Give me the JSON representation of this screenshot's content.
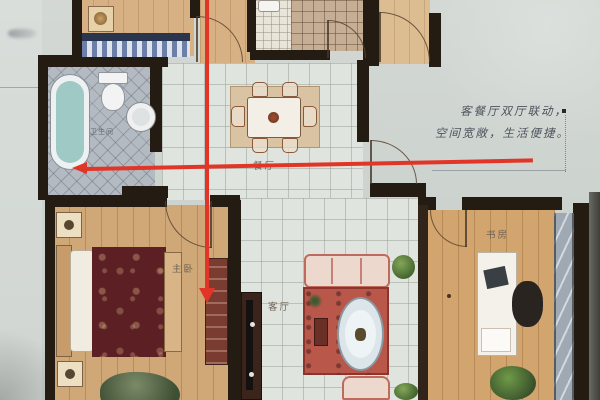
{
  "photo": {
    "kind": "apartment floor plan photograph",
    "page_bg": "#cdd3cf",
    "arrow_color": "#e13527"
  },
  "room_labels": {
    "master_bedroom": "主卧",
    "living_room": "客厅",
    "dining_room": "餐厅",
    "study": "书房",
    "bathroom": "卫生间"
  },
  "annotations": {
    "note_line1": "客餐厅双厅联动，",
    "note_line2": "空间宽敞，生活便捷。"
  }
}
